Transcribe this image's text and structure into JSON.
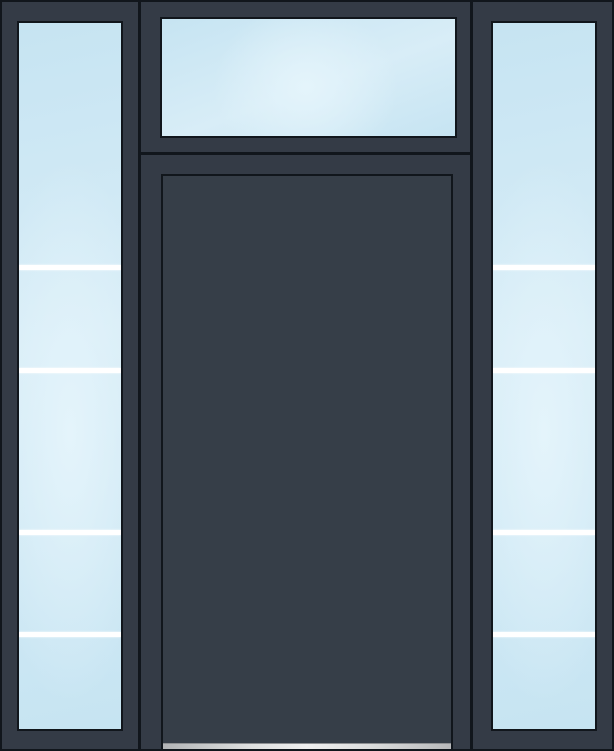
{
  "product": {
    "name": "Entry door unit preview",
    "description": "Dark slate single entry door with solid flush slab, rectangular 1-lite transom above, and two 5-lite glass sidelites",
    "components": {
      "door_slab": "solid flush panel, no glass",
      "transom": "rectangular single-lite transom window",
      "left_sidelite": "full-length sidelite, 5 lites with 4 white divider bars",
      "right_sidelite": "full-length sidelite, 5 lites with 4 white divider bars",
      "sill": "aluminum threshold sill"
    }
  },
  "colors": {
    "frame": "#343B46",
    "slab": "#363E48",
    "seam": "#11161C",
    "glass_edge": "#C6E4F2",
    "glass_mid": "#D8EDF7",
    "glass_highlight": "#E4F4FB",
    "divider": "#FFFFFF",
    "sill_light": "#EFEFEF",
    "sill_dark": "#B2B4B6"
  },
  "sidelite_pattern": {
    "lite_count": 5,
    "divider_count": 4,
    "divider_offsets_px": [
      242,
      345,
      507,
      609
    ],
    "divider_thickness_px": 5
  }
}
